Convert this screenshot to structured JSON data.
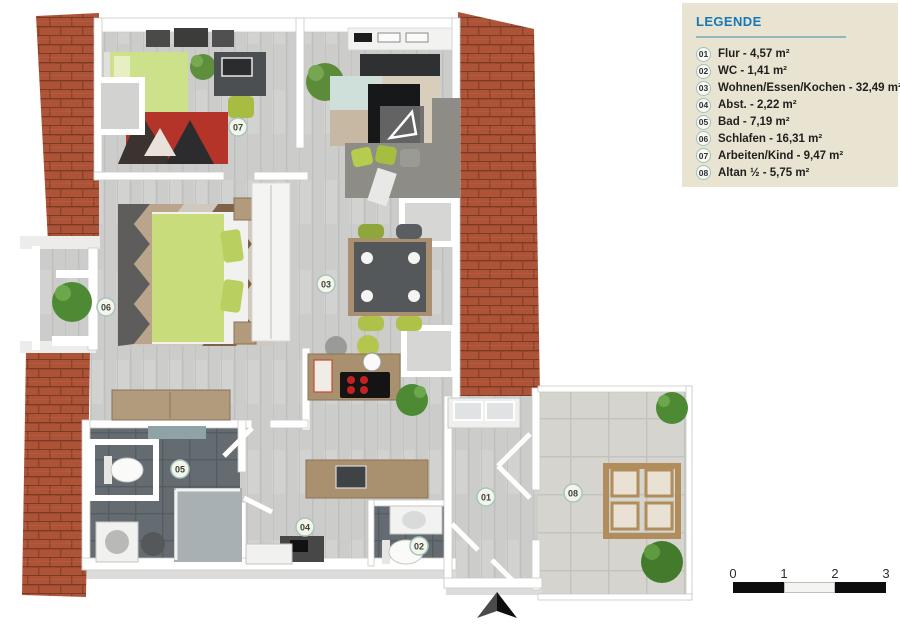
{
  "legend": {
    "title": "LEGENDE",
    "items": [
      {
        "id": "01",
        "label": "Flur",
        "area": "4,57 m²",
        "text": "Flur - 4,57 m²"
      },
      {
        "id": "02",
        "label": "WC",
        "area": "1,41 m²",
        "text": "WC - 1,41 m²"
      },
      {
        "id": "03",
        "label": "Wohnen/Essen/Kochen",
        "area": "32,49 m²",
        "text": "Wohnen/Essen/Kochen - 32,49 m²"
      },
      {
        "id": "04",
        "label": "Abst.",
        "area": "2,22 m²",
        "text": "Abst. - 2,22 m²"
      },
      {
        "id": "05",
        "label": "Bad",
        "area": "7,19 m²",
        "text": "Bad - 7,19 m²"
      },
      {
        "id": "06",
        "label": "Schlafen",
        "area": "16,31 m²",
        "text": "Schlafen - 16,31 m²"
      },
      {
        "id": "07",
        "label": "Arbeiten/Kind",
        "area": "9,47 m²",
        "text": "Arbeiten/Kind - 9,47 m²"
      },
      {
        "id": "08",
        "label": "Altan ½",
        "area": "5,75 m²",
        "text": "Altan ½ - 5,75 m²"
      }
    ]
  },
  "plan": {
    "badges": [
      {
        "id": "01"
      },
      {
        "id": "02"
      },
      {
        "id": "03"
      },
      {
        "id": "04"
      },
      {
        "id": "05"
      },
      {
        "id": "06"
      },
      {
        "id": "07"
      },
      {
        "id": "08"
      }
    ]
  },
  "scale_bar": {
    "labels": [
      "0",
      "1",
      "2",
      "3"
    ]
  },
  "colors": {
    "legend_bg": "#e9e4d1",
    "legend_title": "#1878b6",
    "badge_ring": "#9dc2bd",
    "brick": "#ad5438",
    "floor_plank": "#cccccb",
    "dark_tile": "#636a70",
    "terrace_tile": "#d5d4ce",
    "furniture_green": "#c8dc7c",
    "wall_white": "#ffffff"
  }
}
